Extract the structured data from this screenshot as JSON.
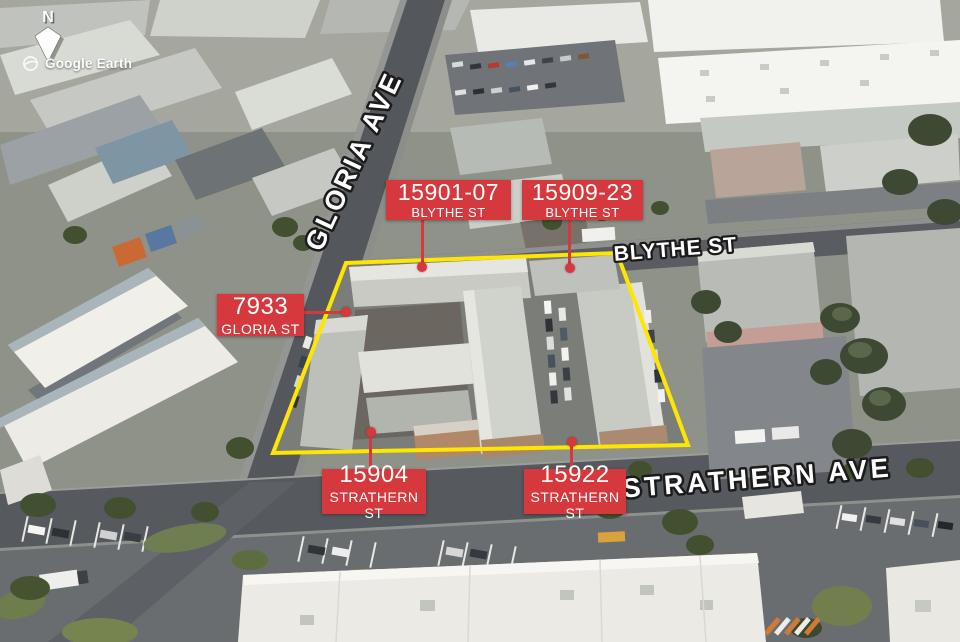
{
  "compass": {
    "label": "N",
    "icon": "north-arrow-icon"
  },
  "logo": {
    "text": "Google Earth",
    "icon": "globe-icon"
  },
  "streets": {
    "gloria_ave": "GLORIA AVE",
    "blythe_st": "BLYTHE ST",
    "strathern_ave": "STRATHERN AVE"
  },
  "property_labels": [
    {
      "address": "15901-07",
      "street": "BLYTHE ST"
    },
    {
      "address": "15909-23",
      "street": "BLYTHE ST"
    },
    {
      "address": "7933",
      "street": "GLORIA ST"
    },
    {
      "address": "15904",
      "street": "STRATHERN ST"
    },
    {
      "address": "15922",
      "street": "STRATHERN ST"
    }
  ],
  "colors": {
    "label_red": "#d6393d",
    "outline_yellow": "#ffe600",
    "street_text": "#ffffff",
    "street_text_outline": "#1b1b1b"
  }
}
